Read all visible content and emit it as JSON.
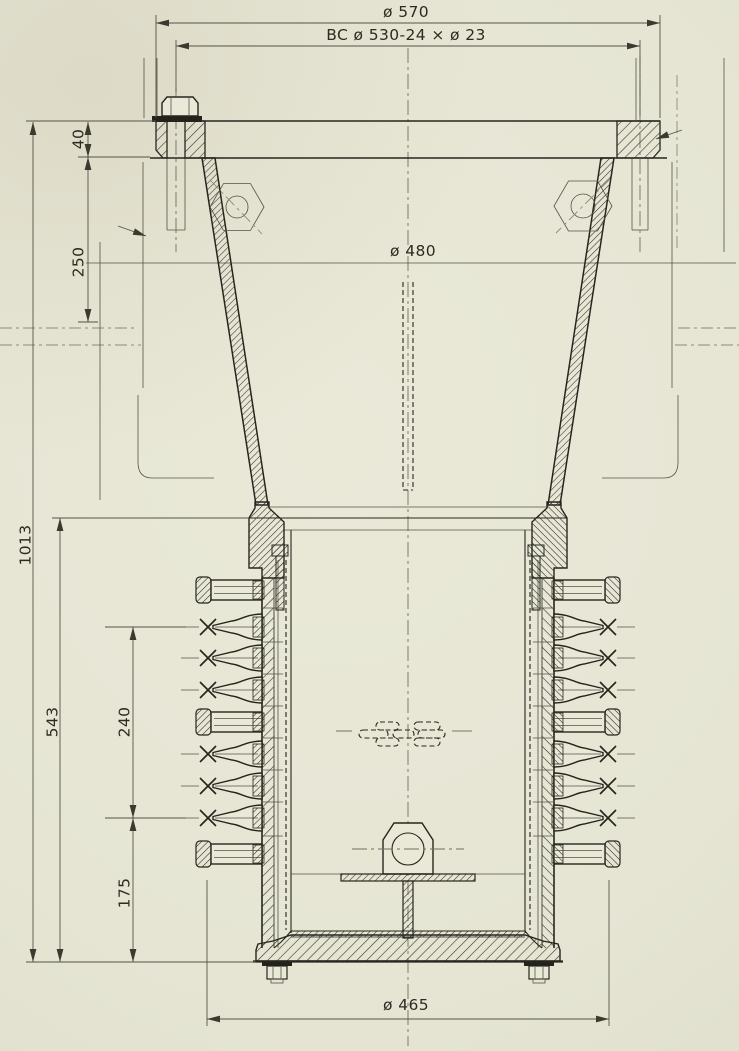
{
  "drawing": {
    "dimensions": {
      "top_outer": "ø 570",
      "bolt_circle": "BC ø 530-24 × ø 23",
      "bore": "ø 480",
      "bottom": "ø 465",
      "flange_thickness": "40",
      "upper_depth": "250",
      "overall_length": "1013",
      "lower_length": "543",
      "nozzle_span": "240",
      "bottom_offset": "175"
    },
    "colors": {
      "paper": "#eae9d8",
      "ink": "#26261e",
      "thin": "#535346",
      "phantom": "#8b8b77"
    }
  }
}
